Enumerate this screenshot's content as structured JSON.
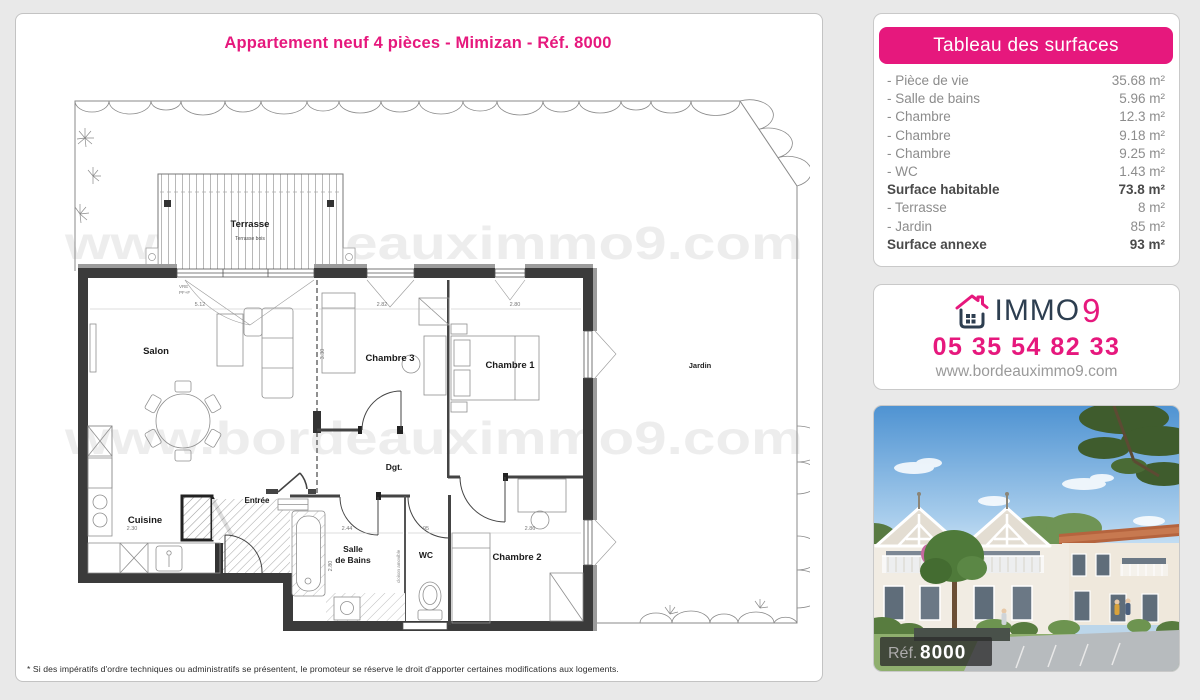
{
  "page": {
    "title": "Appartement neuf 4 pièces - Mimizan - Réf. 8000",
    "footnote": "* Si des impératifs d'ordre techniques ou administratifs se présentent, le promoteur se réserve le droit d'apporter certaines modifications aux logements."
  },
  "surfaces": {
    "header": "Tableau des surfaces",
    "rows": [
      {
        "label": "- Pièce de vie",
        "value": "35.68 m²"
      },
      {
        "label": "- Salle de bains",
        "value": "5.96 m²"
      },
      {
        "label": "- Chambre",
        "value": "12.3 m²"
      },
      {
        "label": "- Chambre",
        "value": "9.18 m²"
      },
      {
        "label": "- Chambre",
        "value": "9.25 m²"
      },
      {
        "label": "- WC",
        "value": "1.43 m²"
      },
      {
        "label": "Surface habitable",
        "value": "73.8 m²"
      },
      {
        "label": "- Terrasse",
        "value": "8 m²"
      },
      {
        "label": "- Jardin",
        "value": "85 m²"
      },
      {
        "label": "Surface annexe",
        "value": "93 m²"
      }
    ]
  },
  "agency": {
    "brand_immo": "IMMO",
    "brand_nine": "9",
    "phone": "05 35 54 82 33",
    "website": "www.bordeauximmo9.com"
  },
  "photo": {
    "ref_label": "Réf.",
    "ref_value": "8000"
  },
  "plan": {
    "watermark": "www.bordeauximmo9.com",
    "labels": {
      "terrasse": "Terrasse",
      "terrasse_sub": "Terrasse bois",
      "salon": "Salon",
      "cuisine": "Cuisine",
      "entree": "Entrée",
      "chambre3": "Chambre 3",
      "chambre1": "Chambre 1",
      "chambre2": "Chambre 2",
      "dgt": "Dgt.",
      "sdb_line1": "Salle",
      "sdb_line2": "de Bains",
      "wc": "WC",
      "jardin": "Jardin",
      "cloison": "cloison amovible"
    },
    "dims": {
      "d1": "5.12",
      "d2": "2.82",
      "d3": "2.80",
      "d4": "2.44",
      "d5": "95",
      "d6": "2.86",
      "d7": "2.30",
      "d8": "3.30",
      "d9": "2.80",
      "w1": "VRE",
      "w2": "PF+F"
    },
    "colors": {
      "accent": "#e6187d",
      "navy": "#2d3e50",
      "wall": "#3b3b3b"
    }
  }
}
